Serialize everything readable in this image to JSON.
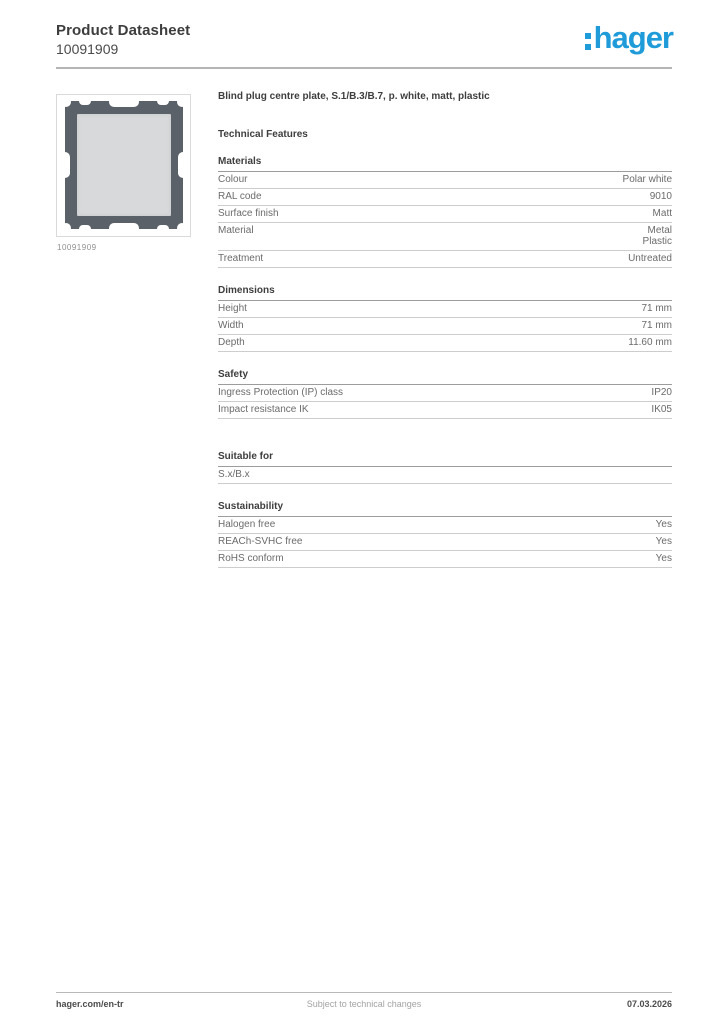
{
  "header": {
    "title": "Product Datasheet",
    "code": "10091909",
    "logo_text": "hager"
  },
  "colors": {
    "brand_blue": "#1e9bd8"
  },
  "product": {
    "title": "Blind plug centre plate, S.1/B.3/B.7, p. white, matt, plastic",
    "image_caption": "10091909"
  },
  "technical": {
    "heading": "Technical Features"
  },
  "sections": [
    {
      "title": "Materials",
      "rows": [
        {
          "label": "Colour",
          "value": "Polar white"
        },
        {
          "label": "RAL code",
          "value": "9010"
        },
        {
          "label": "Surface finish",
          "value": "Matt"
        },
        {
          "label": "Material",
          "value": [
            "Metal",
            "Plastic"
          ]
        },
        {
          "label": "Treatment",
          "value": "Untreated"
        }
      ]
    },
    {
      "title": "Dimensions",
      "rows": [
        {
          "label": "Height",
          "value": "71 mm"
        },
        {
          "label": "Width",
          "value": "71 mm"
        },
        {
          "label": "Depth",
          "value": "11.60 mm"
        }
      ]
    },
    {
      "title": "Safety",
      "rows": [
        {
          "label": "Ingress Protection (IP) class",
          "value": "IP20"
        },
        {
          "label": "Impact resistance IK",
          "value": "IK05"
        }
      ]
    },
    {
      "title": "Suitable for",
      "rows": [
        {
          "label": "S.x/B.x",
          "value": ""
        }
      ]
    },
    {
      "title": "Sustainability",
      "rows": [
        {
          "label": "Halogen free",
          "value": "Yes"
        },
        {
          "label": "REACh-SVHC free",
          "value": "Yes"
        },
        {
          "label": "RoHS conform",
          "value": "Yes"
        }
      ]
    }
  ],
  "footer": {
    "left": "hager.com/en-tr",
    "center": "Subject to technical changes",
    "right": "07.03.2026"
  }
}
